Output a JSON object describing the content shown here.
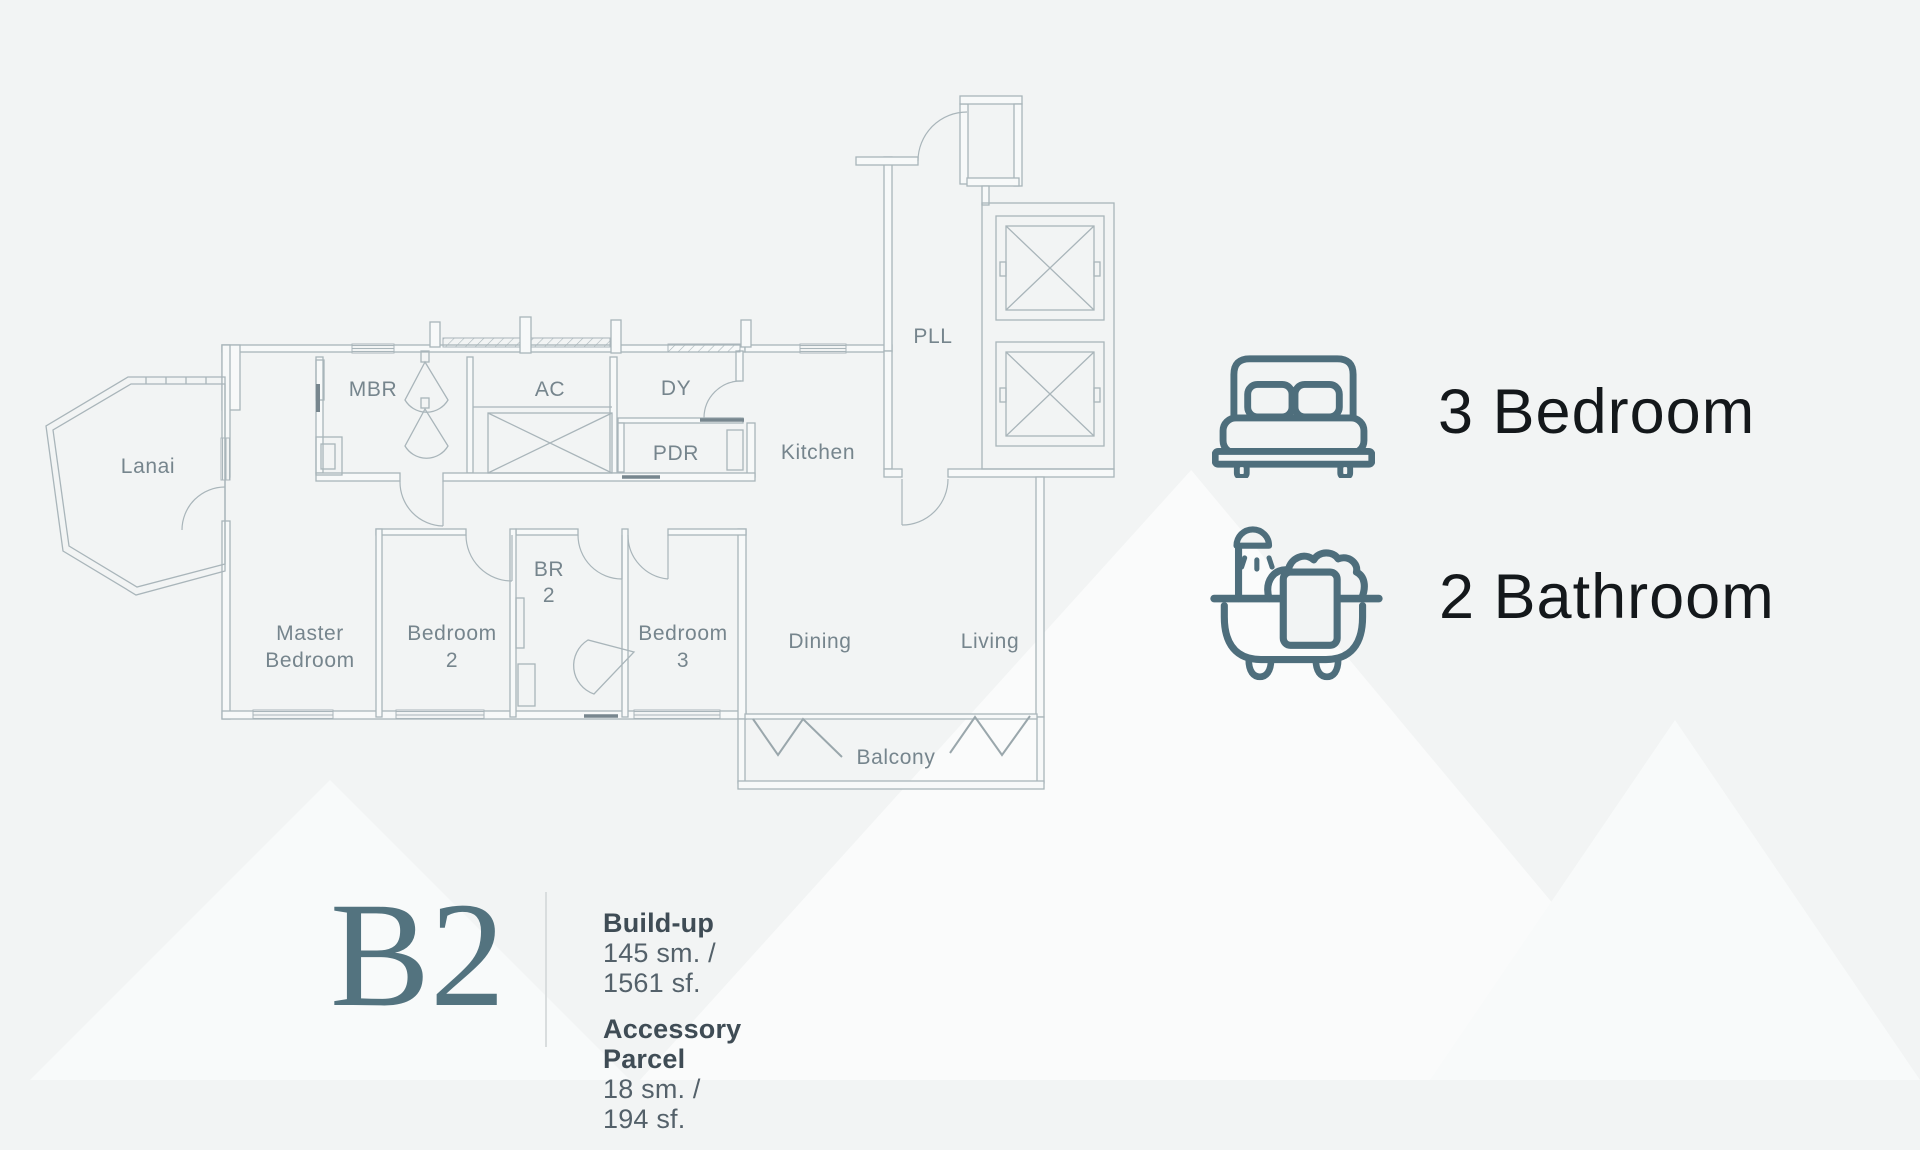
{
  "page": {
    "background": "#f2f4f4"
  },
  "floorplan": {
    "line_color": "#a9b5ba",
    "label_color": "#76858d",
    "rooms": {
      "lanai": {
        "label": "Lanai"
      },
      "mbr": {
        "label": "MBR"
      },
      "ac": {
        "label": "AC"
      },
      "dy": {
        "label": "DY"
      },
      "pdr": {
        "label": "PDR"
      },
      "kitchen": {
        "label": "Kitchen"
      },
      "pll": {
        "label": "PLL"
      },
      "master_bedroom": {
        "line1": "Master",
        "line2": "Bedroom"
      },
      "bedroom2": {
        "line1": "Bedroom",
        "line2": "2"
      },
      "br2": {
        "line1": "BR",
        "line2": "2"
      },
      "bedroom3": {
        "line1": "Bedroom",
        "line2": "3"
      },
      "dining": {
        "label": "Dining"
      },
      "living": {
        "label": "Living"
      },
      "balcony": {
        "label": "Balcony"
      }
    }
  },
  "legend": {
    "icon_color": "#4e6e7c",
    "items": [
      {
        "icon": "bed-icon",
        "label": "3 Bedroom"
      },
      {
        "icon": "bathtub-icon",
        "label": "2 Bathroom"
      }
    ]
  },
  "unit": {
    "code": "B2",
    "code_color": "#53737f",
    "details": [
      {
        "title": "Build-up",
        "value": "145 sm. / 1561 sf."
      },
      {
        "title": "Accessory Parcel",
        "value": "18 sm. / 194 sf."
      }
    ]
  }
}
